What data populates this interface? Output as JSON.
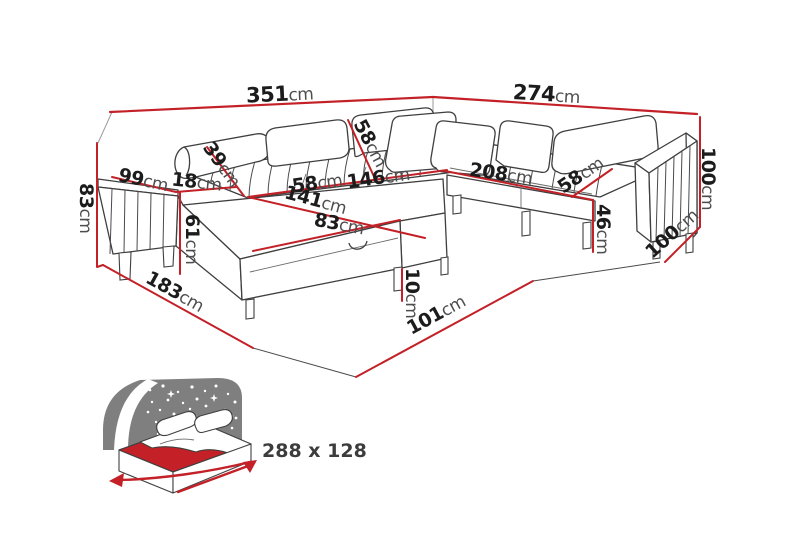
{
  "colors": {
    "dimension_red": "#c32127",
    "outline": "#3f3f3f",
    "night_gray": "#7f7f7f"
  },
  "diagram": {
    "dims": {
      "back_total_width": {
        "value": "351",
        "unit": "cm"
      },
      "right_total_width": {
        "value": "274",
        "unit": "cm"
      },
      "left_wall_height": {
        "value": "83",
        "unit": "cm"
      },
      "left_arm_depth": {
        "value": "99",
        "unit": "cm"
      },
      "armrest_width": {
        "value": "18",
        "unit": "cm"
      },
      "left_backrest_diag": {
        "value": "39",
        "unit": "cm"
      },
      "chaise_side_height": {
        "value": "61",
        "unit": "cm"
      },
      "mid_backrest_diag": {
        "value": "58",
        "unit": "cm"
      },
      "left_seat_width": {
        "value": "58",
        "unit": "cm"
      },
      "mid_seat_width": {
        "value": "146",
        "unit": "cm"
      },
      "chaise_length": {
        "value": "141",
        "unit": "cm"
      },
      "chaise_front_width": {
        "value": "83",
        "unit": "cm"
      },
      "right_seat_width": {
        "value": "208",
        "unit": "cm"
      },
      "right_seat_depth": {
        "value": "58",
        "unit": "cm"
      },
      "seat_height": {
        "value": "46",
        "unit": "cm"
      },
      "right_arm_height": {
        "value": "100",
        "unit": "cm"
      },
      "right_side_depth": {
        "value": "100",
        "unit": "cm"
      },
      "leg_height": {
        "value": "10",
        "unit": "cm"
      },
      "left_floor_depth": {
        "value": "183",
        "unit": "cm"
      },
      "front_floor_width": {
        "value": "101",
        "unit": "cm"
      }
    },
    "sleeping_area": {
      "label": "288 x 128"
    }
  }
}
